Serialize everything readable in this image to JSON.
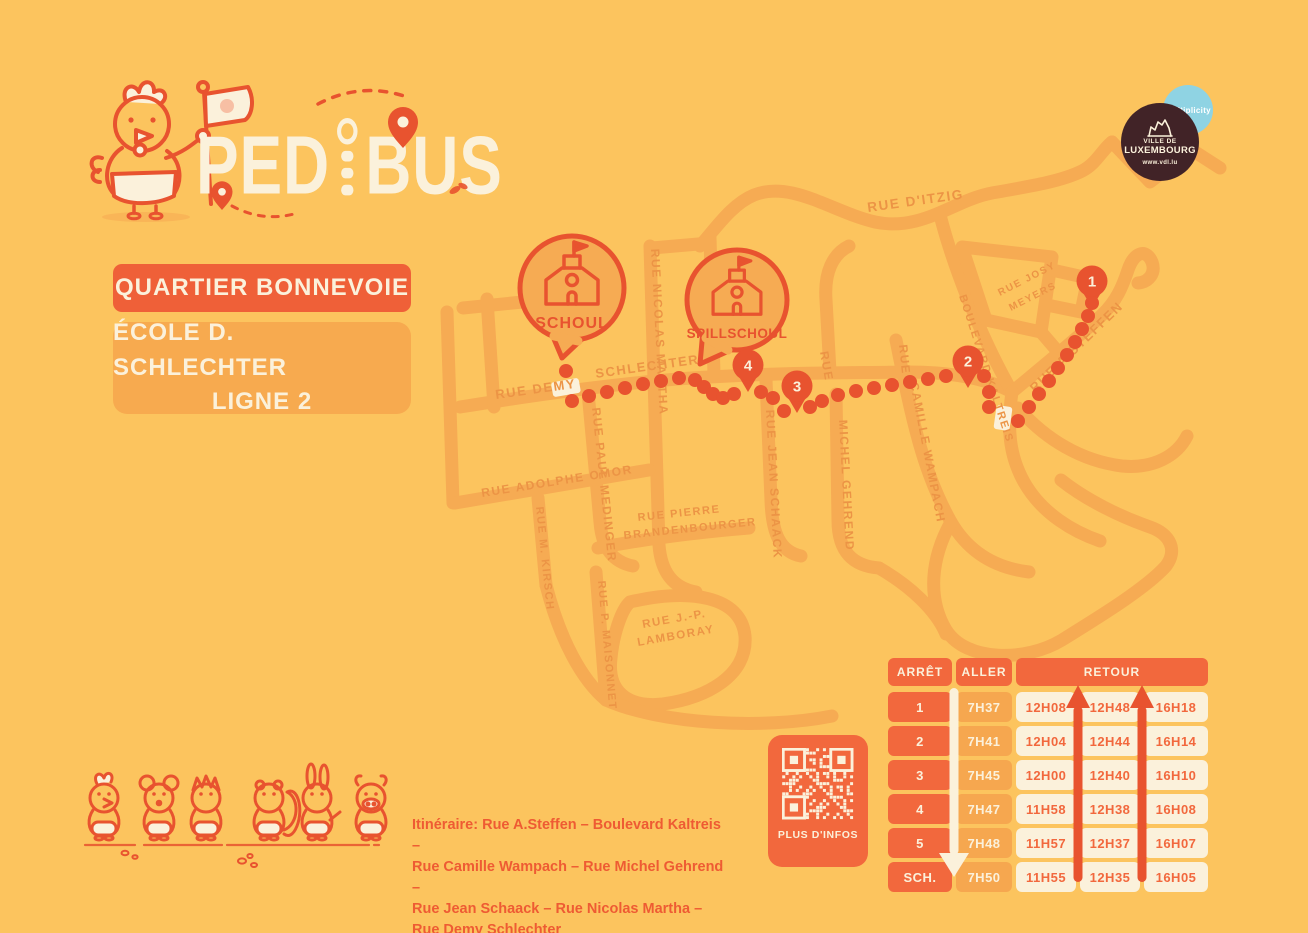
{
  "logo": {
    "brand": "PEDIBUS",
    "part1": "PED",
    "part2": "BUS"
  },
  "badges": {
    "quartier": "QUARTIER BONNEVOIE",
    "school_line1": "ÉCOLE D. SCHLECHTER",
    "school_line2": "LIGNE 2"
  },
  "partners": {
    "multiplicity": "multiplicity",
    "vdl_line1": "VILLE DE",
    "vdl_line2": "LUXEMBOURG",
    "vdl_url": "www.vdl.lu"
  },
  "map": {
    "street_labels": [
      "RUE DEMY",
      "SCHLECHTER",
      "RUE PAUL MEDINGER",
      "RUE NICOLAS MARTHA",
      "RUE JEAN SCHAACK",
      "RUE",
      "MICHEL GEHREND",
      "RUE",
      "CAMILLE WAMPACH",
      "BOULEVARD KALTREIS",
      "RUE A.STEFFEN",
      "RUE D'ITZIG",
      "RUE JOSY",
      "MEYERS",
      "RUE ADOLPHE OMOR",
      "RUE M. KIRSCH",
      "RUE PIERRE",
      "BRANDENBOURGER",
      "RUE P. MAISONNET",
      "RUE J.-P.",
      "LAMBORAY"
    ],
    "stops": [
      "1",
      "2",
      "3",
      "4"
    ],
    "schools": [
      "SCHOUL",
      "SPILLSCHOUL"
    ]
  },
  "itinerary": {
    "text": "Itinéraire: Rue A.Steffen – Boulevard Kaltreis –\nRue Camille Wampach – Rue Michel Gehrend –\nRue Jean Schaack – Rue Nicolas Martha –\nRue Demy Schlechter"
  },
  "qr": {
    "label": "PLUS D'INFOS"
  },
  "timetable": {
    "col_headers": [
      "ARRÊT",
      "ALLER",
      "RETOUR"
    ],
    "rows": [
      {
        "stop": "1",
        "aller": "7H37",
        "retour": [
          "12H08",
          "12H48",
          "16H18"
        ]
      },
      {
        "stop": "2",
        "aller": "7H41",
        "retour": [
          "12H04",
          "12H44",
          "16H14"
        ]
      },
      {
        "stop": "3",
        "aller": "7H45",
        "retour": [
          "12H00",
          "12H40",
          "16H10"
        ]
      },
      {
        "stop": "4",
        "aller": "7H47",
        "retour": [
          "11H58",
          "12H38",
          "16H08"
        ]
      },
      {
        "stop": "5",
        "aller": "7H48",
        "retour": [
          "11H57",
          "12H37",
          "16H07"
        ]
      },
      {
        "stop": "SCH.",
        "aller": "7H50",
        "retour": [
          "11H55",
          "12H35",
          "16H05"
        ]
      }
    ]
  },
  "colors": {
    "background": "#FCC45E",
    "street": "#F6AB53",
    "street_label": "#EC9445",
    "route_accent": "#E8532F",
    "panel_orange": "#F2683D",
    "light_orange": "#F6A74F",
    "cream": "#FBF1DB",
    "partner_blue": "#8FD3E3",
    "partner_brown": "#412327"
  }
}
